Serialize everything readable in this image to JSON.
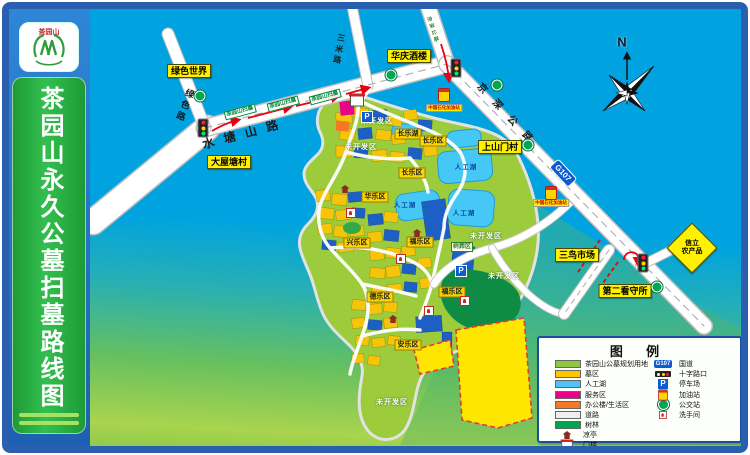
{
  "sidebar": {
    "logo_text": "茶园山",
    "title": "茶园山永久公墓扫墓路线图"
  },
  "compass": {
    "north": "N"
  },
  "roads": {
    "shuitangshan": "水塘山路",
    "lvse": "绿色路",
    "sanmi": "三米路",
    "jingshen": "京深公路",
    "g107": "G107"
  },
  "route": {
    "chip": "茶园山扫墓"
  },
  "pois": {
    "green_world": "绿色世界",
    "dawutang_village": "大屋塘村",
    "huaqing_restaurant": "华庆酒楼",
    "shangshanmen_village": "上山门村",
    "sanniao_market": "三鸟市场",
    "detention_house": "第二看守所",
    "xinli_line1": "信立",
    "xinli_line2": "农产品",
    "sinopec_station": "中国石化加油站"
  },
  "regions": {
    "changle_lake": "长乐湖",
    "changle_a": "长乐区",
    "changle_b": "长乐区",
    "huale": "华乐区",
    "xingle": "兴乐区",
    "fule_a": "福乐区",
    "fule_b": "福乐区",
    "dele": "德乐区",
    "anle": "安乐区",
    "tree_burial": "树葬区",
    "artificial_lake": "人工湖",
    "undeveloped": "未开发区"
  },
  "legend": {
    "title": "图 例",
    "left": [
      {
        "icon": "swatch-planning",
        "color": "#8DC63F",
        "label": "茶园山公墓规划用地"
      },
      {
        "icon": "swatch-grave",
        "color": "#FFC600",
        "label": "墓区"
      },
      {
        "icon": "swatch-lake",
        "color": "#4FC3F7",
        "label": "人工湖"
      },
      {
        "icon": "swatch-service",
        "color": "#EC008C",
        "label": "服务区"
      },
      {
        "icon": "swatch-office",
        "color": "#F47920",
        "label": "办公楼/生活区"
      },
      {
        "icon": "swatch-road",
        "color": "#EFEFEF",
        "label": "道路"
      },
      {
        "icon": "swatch-forest",
        "color": "#00A651",
        "label": "树林"
      },
      {
        "icon": "pavilion-icon",
        "color": "#8E2B20",
        "label": "凉亭"
      },
      {
        "icon": "gate-icon",
        "color": "#C62828",
        "label": "门楼"
      }
    ],
    "right": [
      {
        "icon": "g107-badge",
        "color": "#0B5BD3",
        "label": "国道",
        "badge": "G107"
      },
      {
        "icon": "crossroad-icon",
        "color": "#222222",
        "label": "十字路口"
      },
      {
        "icon": "parking-icon",
        "color": "#0B5BD3",
        "label": "停车场",
        "badge": "P"
      },
      {
        "icon": "gas-icon",
        "color": "#FFD600",
        "label": "加油站"
      },
      {
        "icon": "bus-icon",
        "color": "#00A651",
        "label": "公交站"
      },
      {
        "icon": "restroom-icon",
        "color": "#C62828",
        "label": "洗手间"
      }
    ]
  }
}
